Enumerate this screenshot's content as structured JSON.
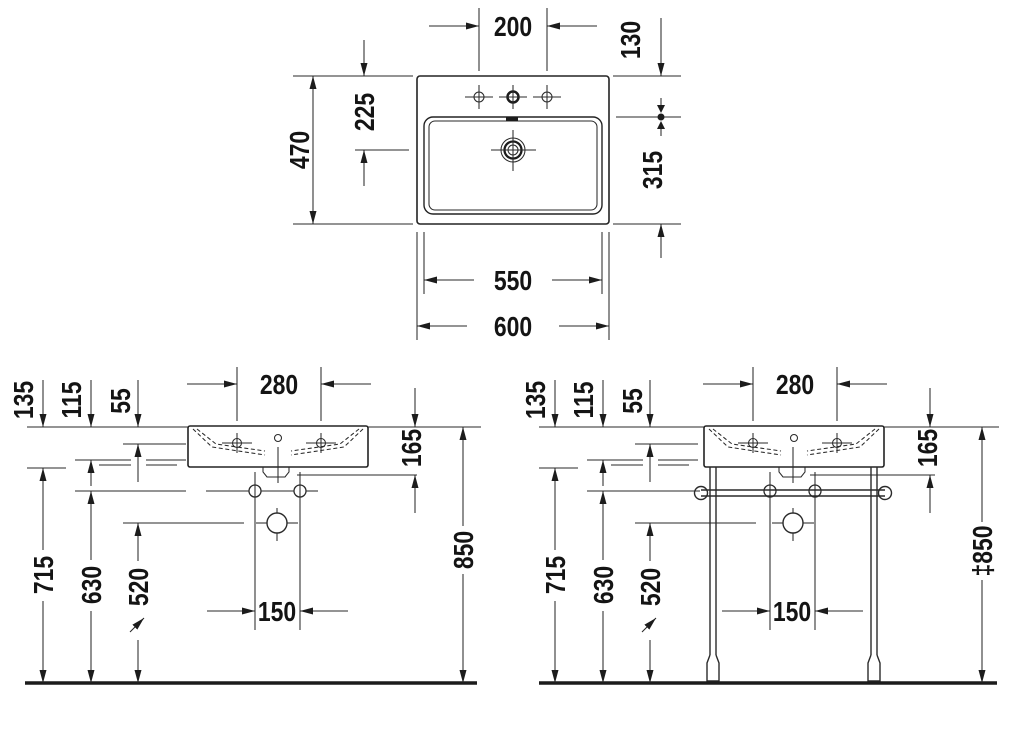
{
  "top_view": {
    "faucet_hole_spacing": "200",
    "back_edge_to_bowl": "130",
    "overall_depth": "470",
    "back_edge_to_drain": "225",
    "bowl_depth": "315",
    "bowl_width": "550",
    "overall_width": "600"
  },
  "front_view": {
    "rim_to_bowl_bottom": "135",
    "rim_to_siphon": "115",
    "rim_to_faucet_axis": "55",
    "faucet_spacing": "280",
    "rim_to_outlet": "165",
    "floor_to_bowl_bottom": "715",
    "floor_to_fixings": "630",
    "floor_to_drain": "520",
    "fixing_spacing": "150",
    "floor_to_rim": "850"
  },
  "console_view": {
    "rim_to_bowl_bottom": "135",
    "rim_to_siphon": "115",
    "rim_to_faucet_axis": "55",
    "faucet_spacing": "280",
    "rim_to_outlet": "165",
    "floor_to_bowl_bottom": "715",
    "floor_to_fixings": "630",
    "floor_to_drain": "520",
    "fixing_spacing": "150",
    "floor_to_rim": "‡850"
  }
}
